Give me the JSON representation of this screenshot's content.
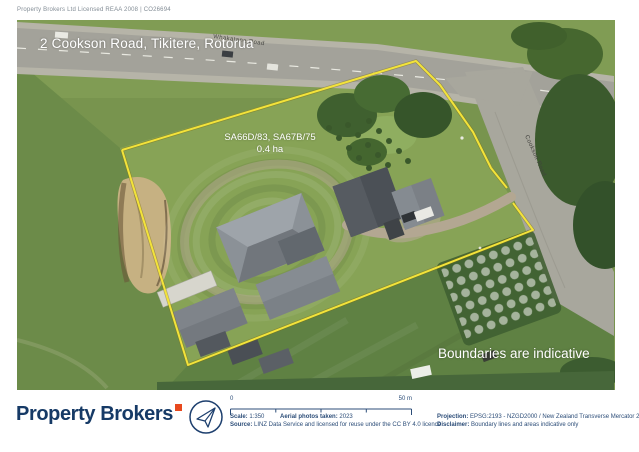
{
  "header": {
    "license": "Property Brokers Ltd Licensed REAA 2008 | CO26694"
  },
  "map": {
    "title": "2 Cookson Road, Tikitere, Rotorua",
    "lot_titles": "SA66D/83, SA67B/75",
    "lot_area": "0.4 ha",
    "boundaries_note": "Boundaries are indicative",
    "road_labels": {
      "highway": "Whakatane Road",
      "side_road": "Cookson Road"
    }
  },
  "footer": {
    "logo_text": "Property Brokers",
    "scalebar": {
      "start_label": "0",
      "end_label": "50 m"
    },
    "meta": {
      "scale_label": "Scale:",
      "scale_value": "1:350",
      "aerial_label": "Aerial photos taken:",
      "aerial_value": "2023",
      "source_label": "Source:",
      "source_value": "LINZ Data Service and licensed for reuse under the CC BY 4.0 licence",
      "projection_label": "Projection:",
      "projection_value": "EPSG:2193 - NZGD2000 / New Zealand Transverse Mercator 2000",
      "disclaimer_label": "Disclaimer:",
      "disclaimer_value": "Boundary lines and areas indicative only"
    }
  },
  "colors": {
    "brand_navy": "#163a66",
    "brand_orange": "#e8491e",
    "boundary_yellow": "#f3e33a",
    "overlay_text": "#ffffff"
  }
}
